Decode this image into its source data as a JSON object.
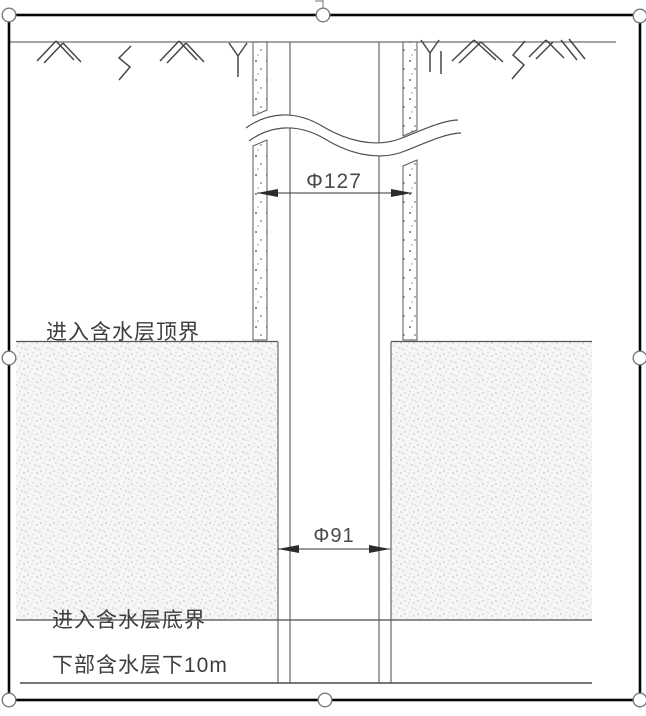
{
  "selection": {
    "frame_color": "#060606",
    "handle_fill": "#ffffff",
    "handle_stroke": "#7a7a7a"
  },
  "drawing": {
    "labels": {
      "aquifer_top_boundary": "进入含水层顶界",
      "aquifer_bottom_boundary": "进入含水层底界",
      "below_lower_aquifer": "下部含水层下10m"
    },
    "dimensions": {
      "casing_diameter": "Φ127",
      "borehole_diameter": "Φ91"
    },
    "colors": {
      "line": "#4f4f4f",
      "boundary_line": "#686868",
      "label_text": "#3d3d3d",
      "dimension_text": "#4a4a4a",
      "sand_dot": "#c9c9c7",
      "casing_speck": "#6b6b6b"
    }
  }
}
